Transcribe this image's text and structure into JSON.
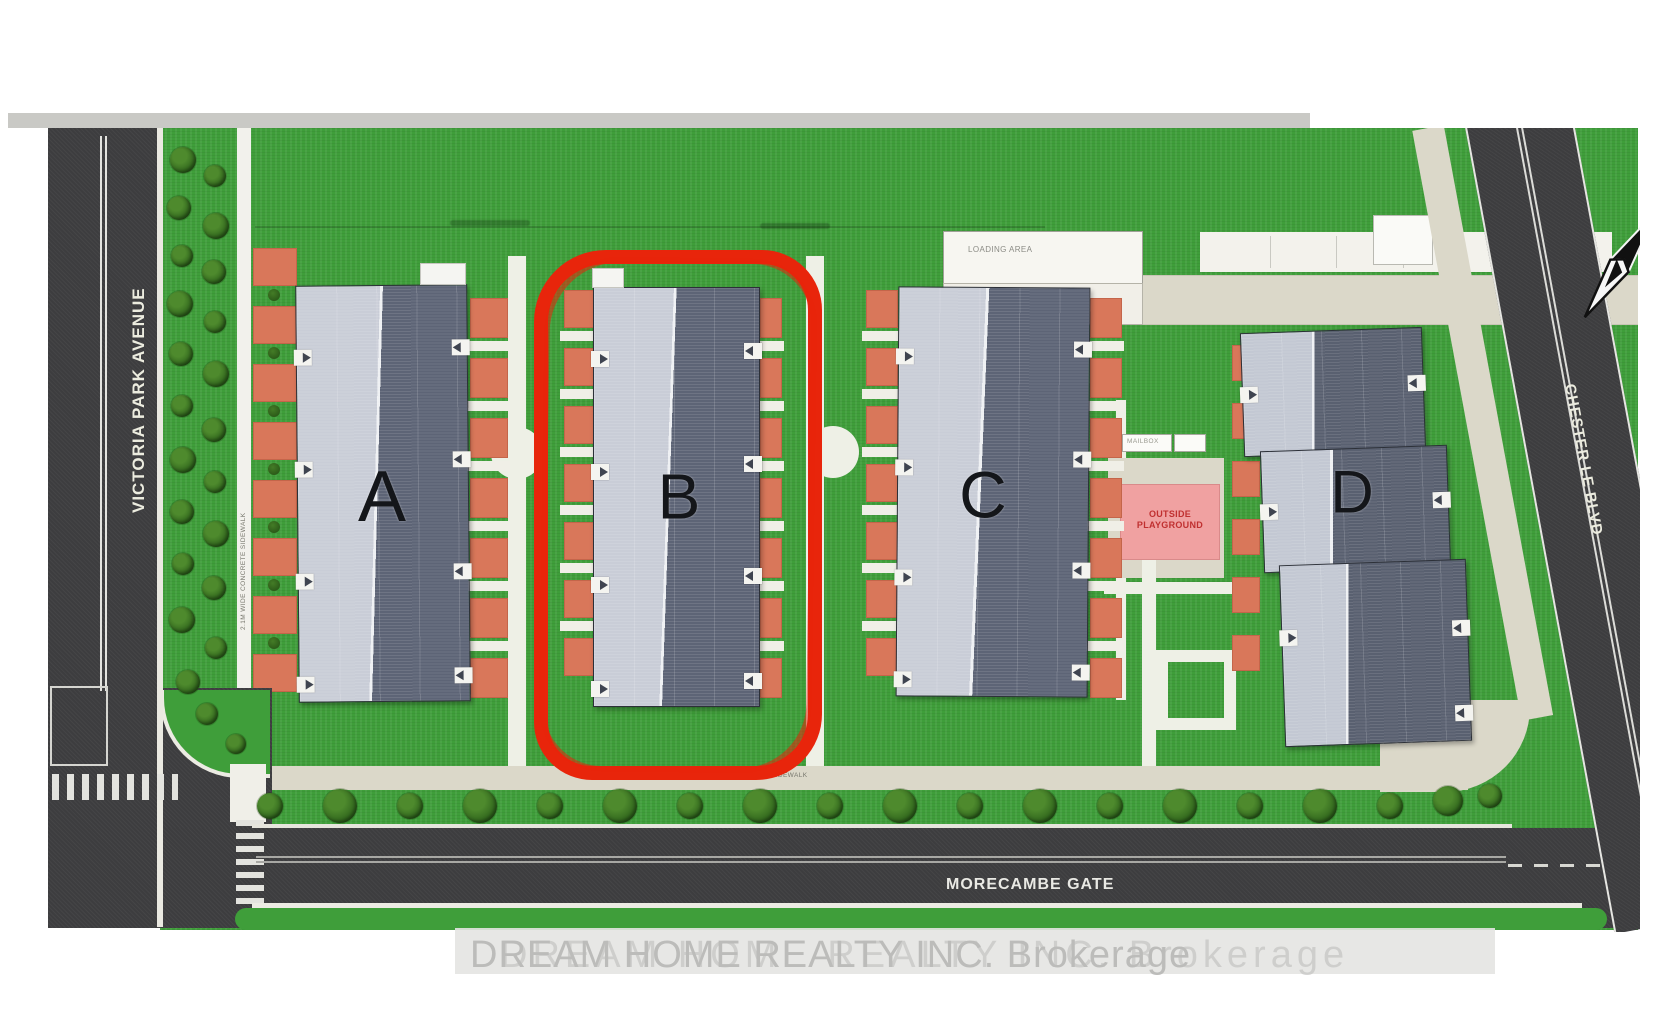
{
  "plan": {
    "streets": {
      "victoria_park": "VICTORIA PARK AVENUE",
      "chester_le": "CHESTER LE BLVD",
      "morecambe": "MORECAMBE GATE"
    },
    "buildings": [
      {
        "id": "A",
        "label": "A",
        "highlighted": false
      },
      {
        "id": "B",
        "label": "B",
        "highlighted": true
      },
      {
        "id": "C",
        "label": "C",
        "highlighted": false
      },
      {
        "id": "D",
        "label": "D",
        "highlighted": false
      }
    ],
    "areas": {
      "loading": "LOADING AREA",
      "playground_line1": "OUTSIDE",
      "playground_line2": "PLAYGROUND",
      "mailbox": "MAILBOX",
      "sidewalk_note": "2.1M WIDE CONCRETE SIDEWALK"
    },
    "annotations": {
      "highlighted_building": "B",
      "highlight_color": "#e8250b"
    },
    "icons": {
      "north_arrow": "north-arrow"
    },
    "colors": {
      "grass": "#3f9e3a",
      "road": "#3d3d3f",
      "roof_light": "#c9cdd7",
      "roof_dark": "#5d6476",
      "patio": "#d9775a",
      "playground_pink": "#f0a1a1",
      "path_beige": "#dbd8c9"
    }
  },
  "watermark": {
    "text": "DREAM HOME REALTY INC. Brokerage"
  }
}
